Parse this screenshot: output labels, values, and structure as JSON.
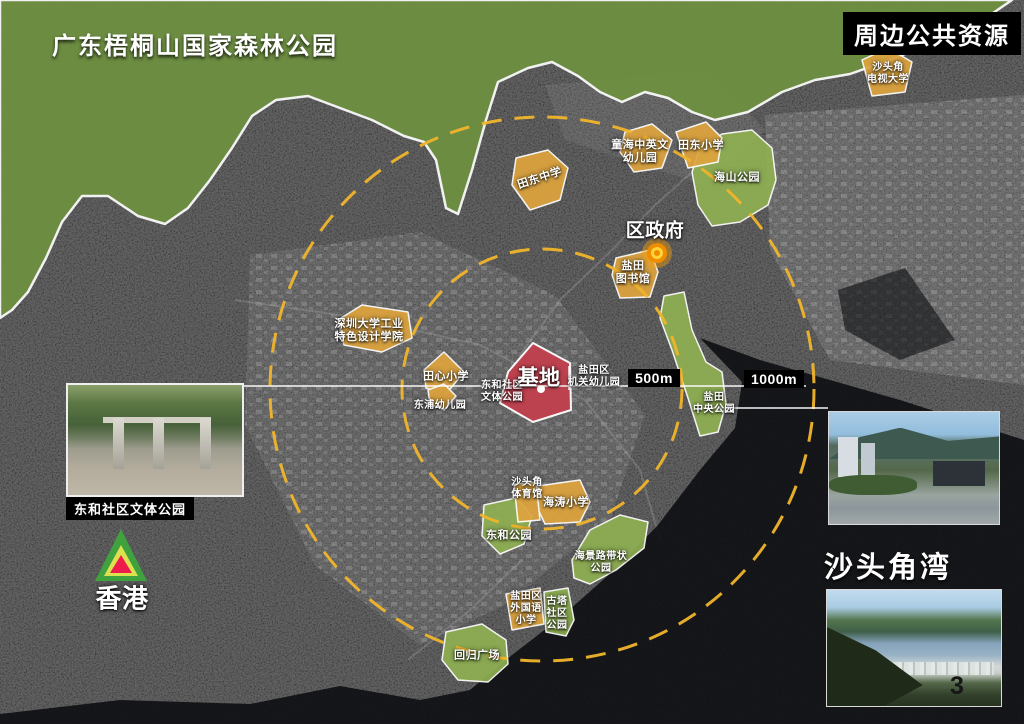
{
  "titles": {
    "forest": "广东梧桐山国家森林公园",
    "resources": "周边公共资源",
    "bay": "沙头角湾",
    "page_number": "3"
  },
  "photos": {
    "left_caption": "东和社区文体公园"
  },
  "distances": {
    "inner": "500m",
    "outer": "1000m"
  },
  "colors": {
    "forest": "#6e9140",
    "park": "#8fb052",
    "school": "#dea43e",
    "site": "#c2404e",
    "ring": "#f0b52b",
    "water": "#0b0d10",
    "marker_glow": "#f59e0b",
    "marker_orange": "#f08c00",
    "marker_yellow": "#ffd43b",
    "hk_green": "#3fa23f",
    "hk_yellow": "#dce24e",
    "hk_red": "#ee1c4d"
  },
  "map_labels": [
    {
      "name": "label-shenzhen-univ-design",
      "text": "深圳大学工业\n特色设计学院",
      "x": 369,
      "y": 331,
      "fs": 11
    },
    {
      "name": "label-tianxin-primary",
      "text": "田心小学",
      "x": 446,
      "y": 377,
      "fs": 11
    },
    {
      "name": "label-dongpu-kindergarten",
      "text": "东浦幼儿园",
      "x": 440,
      "y": 406,
      "fs": 10
    },
    {
      "name": "label-donghe-community-park",
      "text": "东和社区\n文体公园",
      "x": 502,
      "y": 392,
      "fs": 10
    },
    {
      "name": "label-site",
      "text": "基地",
      "x": 539,
      "y": 378,
      "fs": 21
    },
    {
      "name": "label-yantian-gov-kindergarten",
      "text": "盐田区\n机关幼儿园",
      "x": 594,
      "y": 377,
      "fs": 10
    },
    {
      "name": "label-tiandong-middle",
      "text": "田东中学",
      "x": 540,
      "y": 179,
      "fs": 11,
      "rot": -18
    },
    {
      "name": "label-tonghai-kindergarten",
      "text": "童海中英文\n幼儿园",
      "x": 640,
      "y": 152,
      "fs": 11
    },
    {
      "name": "label-tiandong-primary",
      "text": "田东小学",
      "x": 701,
      "y": 146,
      "fs": 11
    },
    {
      "name": "label-haishan-park",
      "text": "海山公园",
      "x": 737,
      "y": 178,
      "fs": 11
    },
    {
      "name": "label-shatoujiao-tv-univ",
      "text": "沙头角\n电视大学",
      "x": 888,
      "y": 74,
      "fs": 10
    },
    {
      "name": "label-yantian-library",
      "text": "盐田\n图书馆",
      "x": 633,
      "y": 273,
      "fs": 11
    },
    {
      "name": "label-district-government",
      "text": "区政府",
      "x": 655,
      "y": 232,
      "fs": 19
    },
    {
      "name": "label-yantian-central-park",
      "text": "盐田\n中央公园",
      "x": 714,
      "y": 404,
      "fs": 10
    },
    {
      "name": "label-shatoujiao-gym",
      "text": "沙头角\n体育馆",
      "x": 527,
      "y": 489,
      "fs": 10
    },
    {
      "name": "label-haitao-primary",
      "text": "海涛小学",
      "x": 566,
      "y": 503,
      "fs": 11
    },
    {
      "name": "label-donghe-park",
      "text": "东和公园",
      "x": 509,
      "y": 536,
      "fs": 11
    },
    {
      "name": "label-haijing-belt-park",
      "text": "海景路带状\n公园",
      "x": 601,
      "y": 563,
      "fs": 10
    },
    {
      "name": "label-yantian-foreign-primary",
      "text": "盐田区\n外国语\n小学",
      "x": 526,
      "y": 609,
      "fs": 10
    },
    {
      "name": "label-guta-community-park",
      "text": "古塔\n社区\n公园",
      "x": 557,
      "y": 614,
      "fs": 10
    },
    {
      "name": "label-huigui-square",
      "text": "回归广场",
      "x": 477,
      "y": 656,
      "fs": 11
    },
    {
      "name": "label-hongkong",
      "text": "香港",
      "x": 122,
      "y": 599,
      "fs": 26
    }
  ]
}
